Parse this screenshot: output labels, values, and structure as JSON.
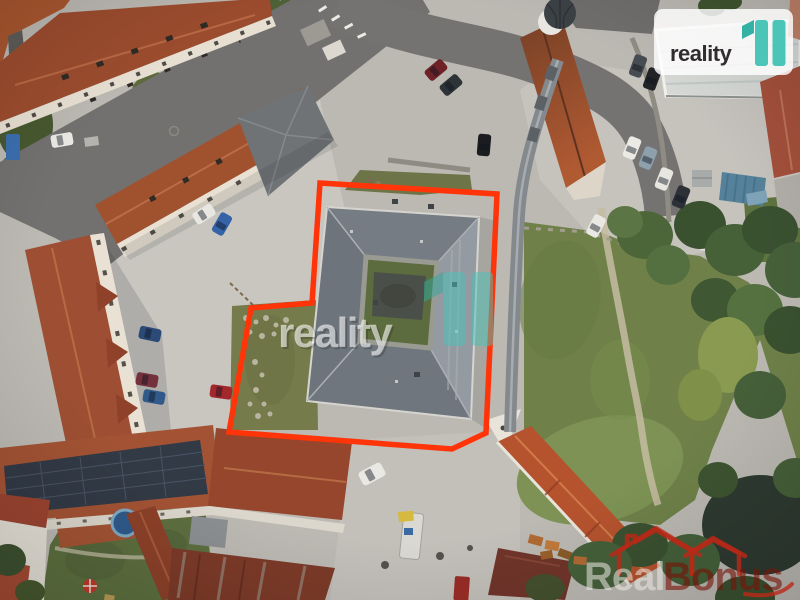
{
  "image": {
    "width": 800,
    "height": 600
  },
  "branding": {
    "logo_text": "reality",
    "logo_mark": "11"
  },
  "watermarks": {
    "center": {
      "text": "reality",
      "mark": "11"
    },
    "realbonus": {
      "real": "Real",
      "bonus": "Bonus"
    }
  },
  "colors": {
    "boundary_red": "#ff3408",
    "logo_text_dark": "#312d2e",
    "logo_teal": "#4cc5b9",
    "logo_teal_dark": "#34b1a5",
    "badge_bg": "rgba(255,255,255,0.82)",
    "watermark_white": "rgba(255,255,255,0.6)",
    "watermark_teal": "rgba(70,196,184,0.5)",
    "watermark_teal_dark": "rgba(45,170,158,0.5)",
    "realbonus_icon_red": "rgba(186,40,22,0.8)",
    "realbonus_real": "rgba(236,234,228,0.55)",
    "realbonus_bonus": "rgba(118,20,8,0.62)"
  }
}
